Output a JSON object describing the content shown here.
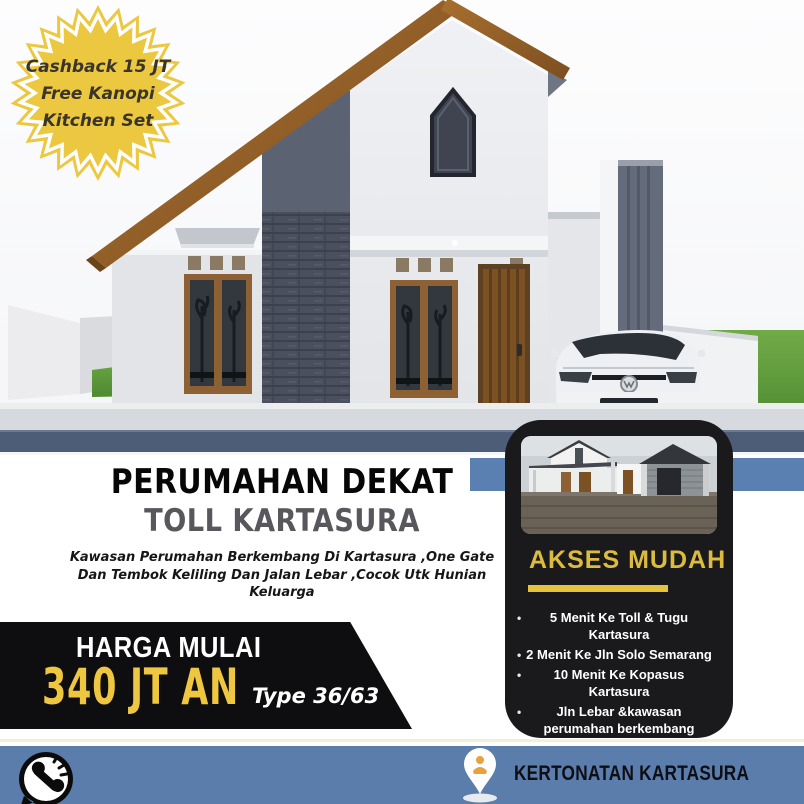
{
  "badge": {
    "lines": [
      "Cashback 15 JT",
      "Free Kanopi",
      "Kitchen Set"
    ],
    "bg_color": "#ecc740",
    "text_color": "#3a352a"
  },
  "headline": {
    "title1": "PERUMAHAN DEKAT",
    "title2": "TOLL KARTASURA",
    "subtitle_lines": [
      "Kawasan Perumahan Berkembang Di Kartasura ,One Gate",
      "Dan Tembok Keliling Dan Jalan Lebar ,Cocok Utk Hunian",
      "Keluarga"
    ]
  },
  "price_banner": {
    "label": "HARGA MULAI",
    "price": "340 JT AN",
    "type_label": "Type 36/63",
    "bg_color": "#0e0e10",
    "price_color": "#eec63f"
  },
  "access_card": {
    "heading": "AKSES MUDAH",
    "heading_color": "#dcbc3e",
    "bg_color": "#1a1a1c",
    "items": [
      "5 Menit Ke Toll & Tugu Kartasura",
      "2 Menit Ke Jln Solo Semarang",
      "10 Menit Ke Kopasus Kartasura",
      "Jln Lebar &kawasan perumahan berkembang"
    ]
  },
  "footer": {
    "location": "KERTONATAN KARTASURA",
    "bg_color": "#5b7dab",
    "icons": [
      "phone-icon",
      "location-pin-icon"
    ]
  },
  "palette": {
    "promo_band_blue": "#5a80b1",
    "road_slate": "#4d5d77",
    "roof_brown": "#96602a",
    "accent_yellow": "#e3c43c"
  }
}
